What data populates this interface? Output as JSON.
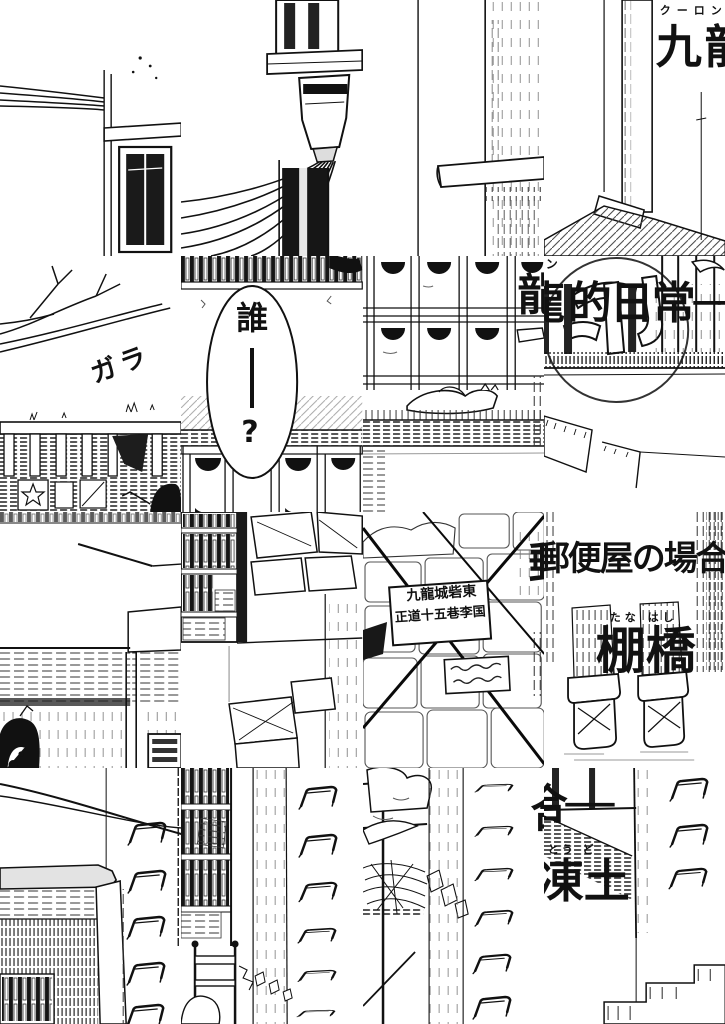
{
  "page": {
    "kind": "manga title page (scrambled 4x4 tiles)",
    "paper": "#ffffff",
    "ink": "#111111"
  },
  "title": {
    "kowloon": "九龍",
    "kowloon_ruby": "クーロン",
    "ryu_partial": "龍",
    "no_nichijou": "的日常──",
    "ruby_n": "ン",
    "yubin_partial": "郵",
    "yubinya_no_baai": "郵便屋の場合",
    "go_dash": "合──",
    "go_partial": "合"
  },
  "author": {
    "surname": "棚橋",
    "surname_ruby": "たな はし",
    "given": "凍土",
    "given_ruby": "とう ど"
  },
  "speech_bubble": {
    "who": "誰",
    "dash": "──",
    "question": "?",
    "full": "誰──?"
  },
  "sfx": {
    "gara": "ガラ"
  },
  "signs": {
    "address_line1": "九龍城砦東",
    "address_line2": "正道十五巷李国",
    "small_sign": {
      "legible": false
    }
  }
}
